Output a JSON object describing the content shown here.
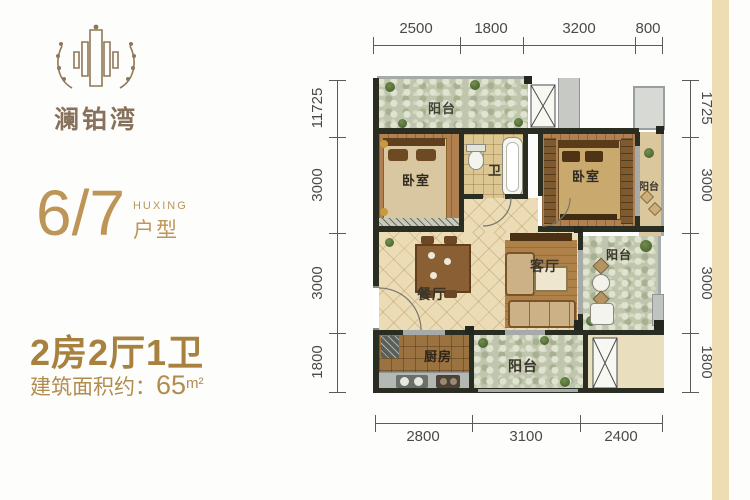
{
  "brand": {
    "logo_text": "澜铂湾"
  },
  "unit": {
    "number": "6/7",
    "label_en": "HUXING",
    "label_cn": "户型"
  },
  "summary": {
    "rooms": "2房2厅1卫",
    "area_prefix": "建筑面积约：",
    "area_value": "65",
    "area_unit": "m²"
  },
  "floor_plan": {
    "dimensions": {
      "top": [
        "2500",
        "1800",
        "3200",
        "800"
      ],
      "bottom": [
        "2800",
        "3100",
        "2400"
      ],
      "left": [
        "11725",
        "3000",
        "3000",
        "1800"
      ],
      "right": [
        "1725",
        "3000",
        "3000",
        "1800"
      ]
    },
    "rooms": {
      "balcony_top": "阳台",
      "bedroom_left": "卧室",
      "bath": "卫",
      "bedroom_right": "卧室",
      "balcony_right": "阳台",
      "dining": "餐厅",
      "living": "客厅",
      "balcony_garden": "阳台",
      "kitchen": "厨房",
      "balcony_bottom": "阳台"
    }
  },
  "colors": {
    "accent_gold": "#b3904e",
    "logo_brown": "#8a7258",
    "wall_dark": "#2a2e22",
    "dim_line": "#5a5a5a",
    "side_stripe": "#eedcb2"
  }
}
